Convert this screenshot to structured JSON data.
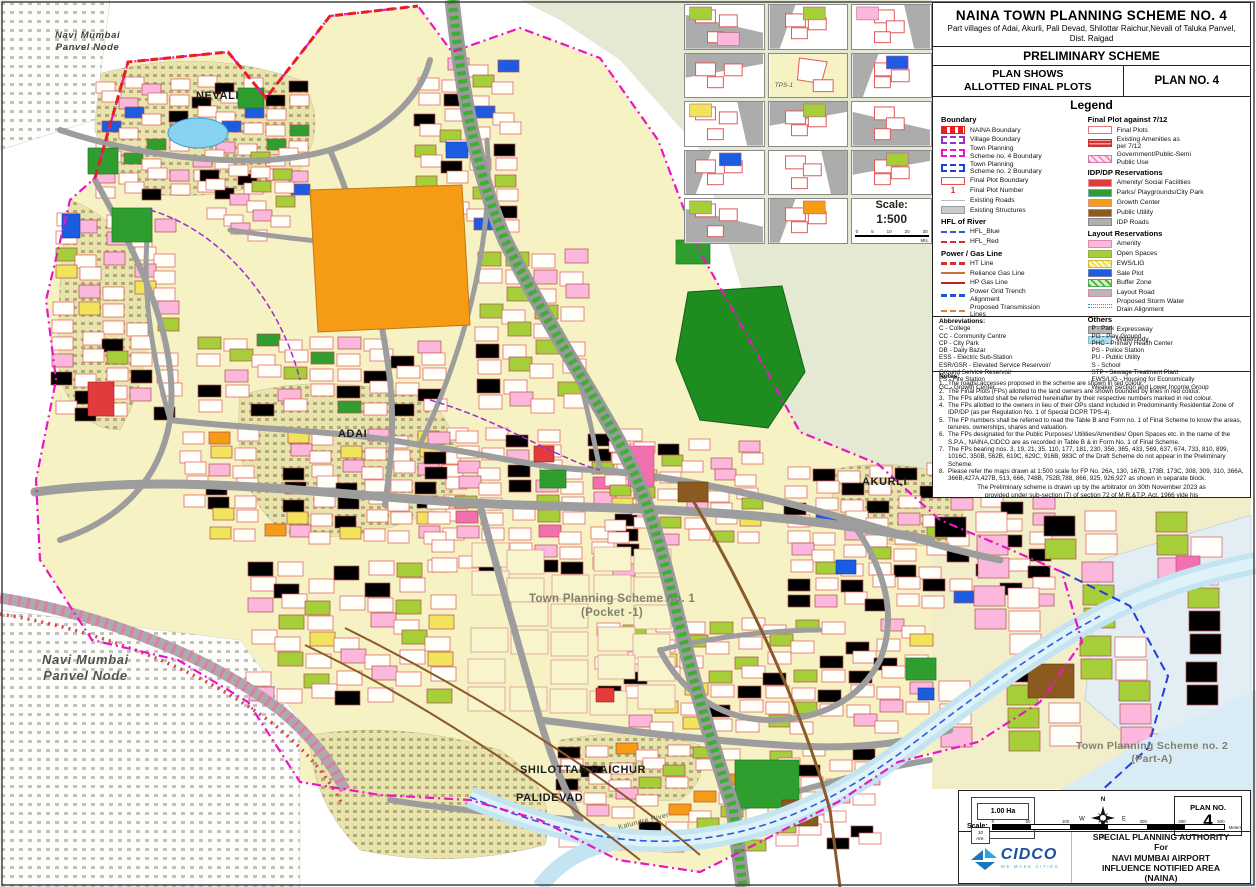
{
  "title_block": {
    "title": "NAINA TOWN PLANNING SCHEME NO. 4",
    "subtitle": "Part villages of Adai, Akurli, Pali Devad, Shilottar Raichur,Nevali of Taluka Panvel, Dist. Raigad",
    "scheme_type": "PRELIMINARY SCHEME",
    "plan_shows": "PLAN SHOWS\nALLOTTED FINAL PLOTS",
    "plan_no_label": "PLAN NO. 4",
    "legend_title": "Legend"
  },
  "legend": {
    "boundary": {
      "heading": "Boundary",
      "items": [
        {
          "label": "NAINA Boundary",
          "swatch": "naina"
        },
        {
          "label": "Village Boundary",
          "swatch": "village"
        },
        {
          "label": "Town Planning\nScheme no. 4 Boundary",
          "swatch": "tps4"
        },
        {
          "label": "Town Planning\nScheme no. 2 Boundary",
          "swatch": "tps2"
        },
        {
          "label": "Final Plot Boundary",
          "swatch": "fp-boundary"
        },
        {
          "label": "Final Plot Number",
          "swatch": "fp-number",
          "glyph": "1"
        },
        {
          "label": "Existing Roads",
          "swatch": "ex-roads"
        },
        {
          "label": "Existing Structures",
          "swatch": "ex-structures"
        }
      ]
    },
    "hfl": {
      "heading": "HFL of River",
      "items": [
        {
          "label": "HFL_Blue",
          "swatch": "hfl-blue"
        },
        {
          "label": "HFL_Red",
          "swatch": "hfl-red"
        }
      ]
    },
    "power_gas": {
      "heading": "Power / Gas Line",
      "items": [
        {
          "label": "HT Line",
          "swatch": "ht-line"
        },
        {
          "label": "Reliance Gas Line",
          "swatch": "reliance-gas"
        },
        {
          "label": "HP Gas Line",
          "swatch": "hp-gas"
        },
        {
          "label": "Power Grid Trench\nAlignment",
          "swatch": "grid-trench"
        },
        {
          "label": "Proposed Transmission\nLines",
          "swatch": "prop-trans"
        }
      ]
    },
    "final_plot": {
      "heading": "Final Plot against 7/12",
      "items": [
        {
          "label": "Final Plots",
          "swatch": "final-plots"
        },
        {
          "label": "Existing Amenities as\nper 7/12",
          "swatch": "ex-amenities"
        },
        {
          "label": "Government/Public-Semi\nPublic Use",
          "swatch": "govt-public"
        }
      ]
    },
    "idp_dp": {
      "heading": "IDP/DP Reservations",
      "items": [
        {
          "label": "Amenity/ Social Facilities",
          "swatch": "amenity-social"
        },
        {
          "label": "Parks/ Playgrounds/City Park",
          "swatch": "parks"
        },
        {
          "label": "Growth Center",
          "swatch": "growth"
        },
        {
          "label": "Public Utility",
          "swatch": "utility"
        },
        {
          "label": "IDP Roads",
          "swatch": "idp-roads"
        }
      ]
    },
    "layout_res": {
      "heading": "Layout Reservations",
      "items": [
        {
          "label": "Amenity",
          "swatch": "amenity"
        },
        {
          "label": "Open Spaces",
          "swatch": "open-spaces"
        },
        {
          "label": "EWS/LIG",
          "swatch": "ews"
        },
        {
          "label": "Sale Plot",
          "swatch": "sale"
        },
        {
          "label": "Buffer Zone",
          "swatch": "buffer"
        },
        {
          "label": "Layout Road",
          "swatch": "layout-road"
        },
        {
          "label": "Proposed Storm Water\nDrain Alignment",
          "swatch": "storm"
        }
      ]
    },
    "others": {
      "heading": "Others",
      "items": [
        {
          "label": "Expressway",
          "swatch": "expressway"
        },
        {
          "label": "Waterbody",
          "swatch": "waterbody"
        }
      ]
    }
  },
  "abbreviations": {
    "heading": "Abbreviations:",
    "left": [
      "C - College",
      "CC - Community Centre",
      "CP - City Park",
      "DB - Daily Bazar",
      "ESS - Electric Sub-Station",
      "ESR/GSR - Elevated Service Reservoir/",
      "        Ground Service Reservoir",
      "FS - Fire Station",
      "GC - Growth Center"
    ],
    "right": [
      "P - Park",
      "PG - Play Ground",
      "PHC - Primary Health Center",
      "PS - Police Station",
      "PU - Public Utility",
      "S - School",
      "STP - Sewage Treatment Plant",
      "EWS/LIG - Housing for Economically",
      "Weaker Section and Lower Income Group"
    ]
  },
  "notes": {
    "heading": "Notes:",
    "items": [
      "The roads/ accesses proposed in the scheme are shown in red colour.",
      "The Final Plots (FPs) allotted to the land owners are shown bounded by lines in red colour.",
      "The FPs allotted shall be referred hereinafter by their respective numbers marked in red colour.",
      "The FPs allotted to the owners in lieu of their OPs stand included in Predominantly Residential Zone of IDP/DP (as per Regulation No. 1 of Special DCPR TPS-4).",
      "The FP numbers shall be referred to read the Table B and Form no. 1 of Final Scheme to know the areas, tenures, ownerships, shares and valuation.",
      "The FPs designated for the Public Purposes/ Utilities/Amenities/ Open Spaces etc. in the name of the S.P.A., NAINA,CIDCO are as recorded in Table B & in Form No. 1 of Final Scheme.",
      "The FPs bearing nos. 3, 19, 21, 35, 110, 177, 181, 230, 356, 365, 433, 569, 637, 674, 733, 810, 899, 1016C, 350B, 562B, 619C, 629C, 916B, 983C of the Draft Scheme do not appear in the Preliminary Scheme.",
      "Please refer the maps drawn at 1:500 scale for FP No. 26A, 130, 167B, 173B, 173C, 308, 309, 310, 366A, 366B,427A,427B, 513, 666, 748B, 752B,788, 866, 925, 926,927 as shown in separate block."
    ],
    "closing": "The Preliminary scheme is drawn up by the arbitrator on 30th November 2023 as\nprovided under sub-section (7) of section 72 of M.R.&T.P. Act, 1966 vide his\nNotice No. ARB/ TPS-4/Award/2023/624 dated 30th November 2023",
    "signature_lines": [
      "(Shrirang D. Landge)",
      "Arbitrator",
      "NAINA Town Planning Scheme No. 4"
    ]
  },
  "map_labels": {
    "nevali": "NEVALI",
    "adai": "ADAI",
    "akurli": "AKURLI",
    "shilottar_raichur": "SHILOTTAR RAICHUR",
    "palidevad": "PALIDEVAD",
    "tps1": "Town Planning Scheme no. 1\n(Pocket -1)",
    "tps2": "Town Planning Scheme no. 2\n(Part-A)",
    "panvel_node_top": "Navi Mumbai\nPanvel Node",
    "panvel_node_left": "Navi Mumbai\nPanvel Node",
    "kalundre_river": "Kalundre River"
  },
  "inset_grid": {
    "tps_label": "TPS-1",
    "scale_label": "Scale:",
    "scale_value": "1:500",
    "scale_ticks": [
      "0",
      "5",
      "10",
      "20",
      "30"
    ],
    "scale_unit": "Mts.",
    "cells": [
      {
        "type": "map",
        "accents": [
          "open",
          "amenity"
        ]
      },
      {
        "type": "map",
        "accents": [
          "open"
        ]
      },
      {
        "type": "map",
        "accents": [
          "amenity"
        ]
      },
      {
        "type": "map",
        "accents": []
      },
      {
        "type": "tps"
      },
      {
        "type": "map",
        "accents": [
          "sale"
        ]
      },
      {
        "type": "map",
        "accents": [
          "ews"
        ]
      },
      {
        "type": "map",
        "accents": [
          "open"
        ]
      },
      {
        "type": "map",
        "accents": []
      },
      {
        "type": "map",
        "accents": [
          "sale"
        ]
      },
      {
        "type": "map",
        "accents": []
      },
      {
        "type": "map",
        "accents": [
          "open"
        ]
      },
      {
        "type": "map",
        "accents": [
          "open"
        ]
      },
      {
        "type": "map",
        "accents": [
          "growth"
        ]
      },
      {
        "type": "scale"
      }
    ]
  },
  "authority_block": {
    "area_ha": "1.00 Ha",
    "area_are": "10\nAre.",
    "plan_no_label": "PLAN NO.",
    "plan_no": "4",
    "scale_label": "Scale:",
    "scale_ticks": [
      "0",
      "50",
      "100",
      "200",
      "300",
      "400",
      "500"
    ],
    "scale_unit": "Meters",
    "compass_points": {
      "n": "N",
      "e": "E",
      "s": "S",
      "w": "W"
    },
    "logo_name": "CIDCO",
    "logo_tagline": "WE MAKE CITIES",
    "authority_lines": [
      "SPECIAL PLANNING AUTHORITY",
      "For",
      "NAVI MUMBAI AIRPORT",
      "INFLUENCE NOTIFIED AREA",
      "(NAINA)"
    ]
  },
  "colors": {
    "naina_red": "#E81F1F",
    "village_purple": "#9A2FD0",
    "boundary_magenta": "#EC13C8",
    "tps2_blue": "#1F3FD8",
    "amenity_red": "#E23B3B",
    "parks_green": "#2F9E2F",
    "growth_orange": "#F59B14",
    "utility_brown": "#8C5A1E",
    "amenity_pink": "#FBB8DC",
    "open_green": "#A6CE39",
    "ews_yellow": "#F2E35C",
    "sale_blue": "#1D5BE0",
    "buffer_green": "#4CAF3E",
    "water_blue": "#A8DCF0",
    "cream_land": "#F6F2C3",
    "road_gray": "#9D9D9D"
  }
}
